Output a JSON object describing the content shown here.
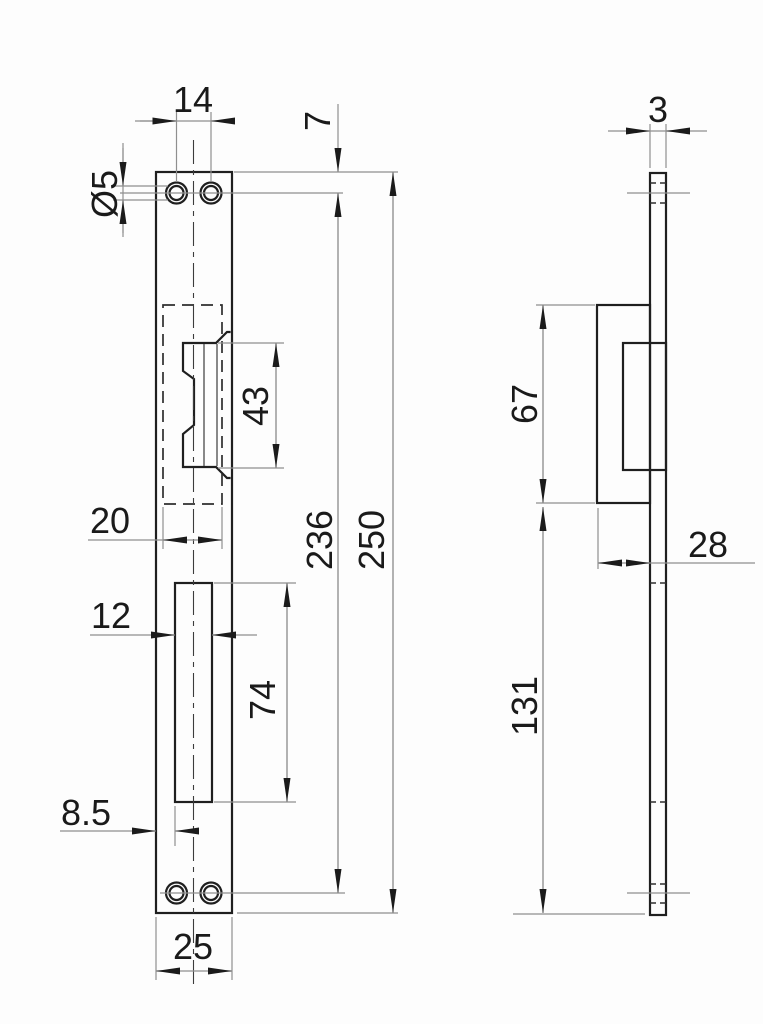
{
  "drawing": {
    "front_view": {
      "dimensions": {
        "hole_spacing": "14",
        "top_edge_to_hole": "7",
        "hole_diameter": "Ø5",
        "keeper_opening_height": "43",
        "cutout_width": "20",
        "hole_span": "236",
        "overall_length": "250",
        "slot_width": "12",
        "slot_height": "74",
        "edge_to_slot": "8.5",
        "plate_width": "25"
      }
    },
    "side_view": {
      "dimensions": {
        "plate_thickness": "3",
        "keeper_box_height": "67",
        "keeper_box_depth": "28",
        "box_to_bottom": "131"
      }
    }
  },
  "colors": {
    "object_line": "#1f1f1f",
    "dimension_line": "#8f8f8f",
    "text": "#1a1a1a",
    "background": "#fdfdfd"
  }
}
